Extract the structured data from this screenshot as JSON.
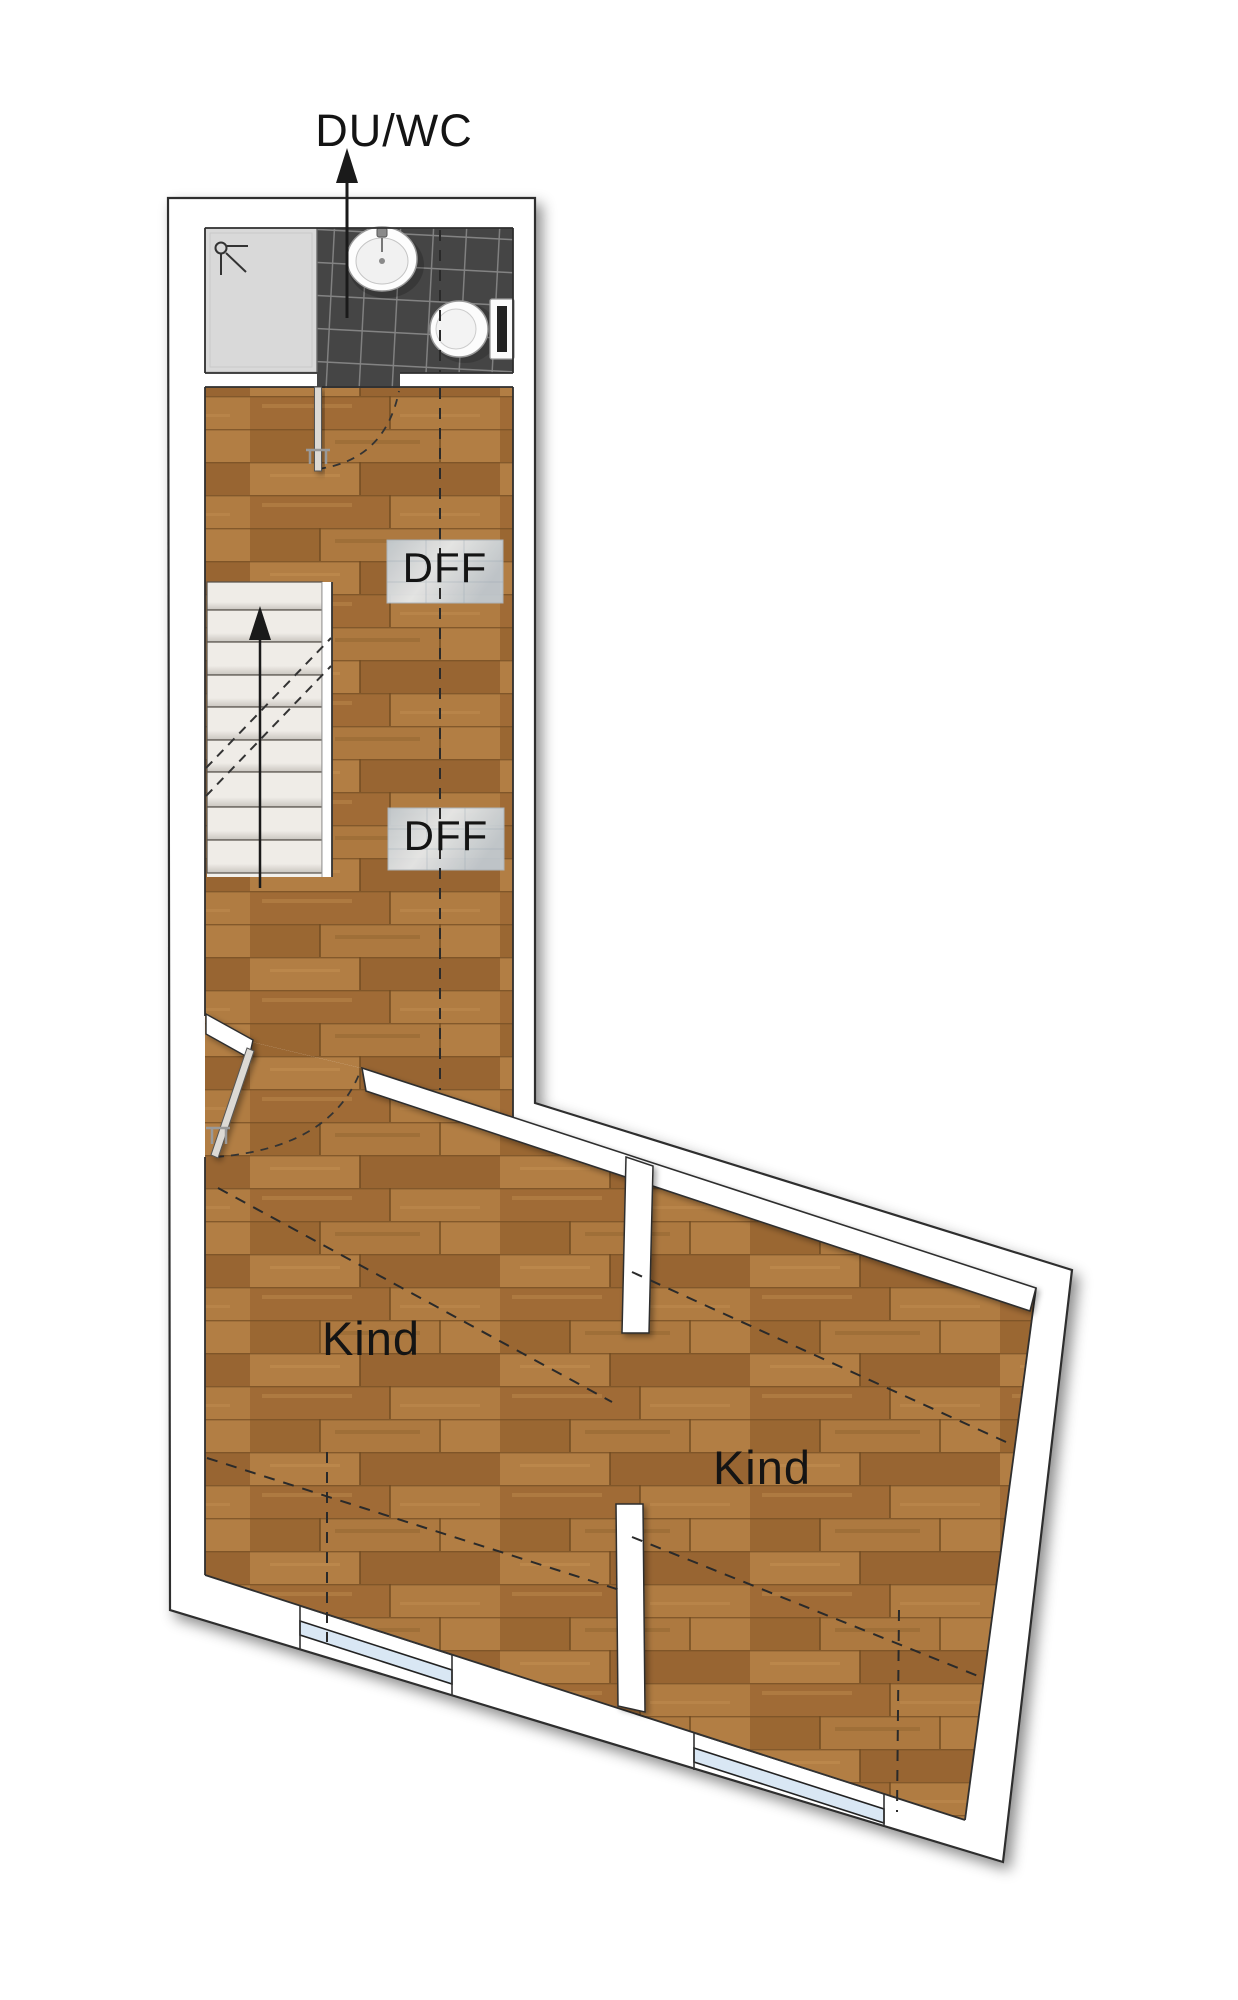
{
  "plan": {
    "bathroom_label": "DU/WC",
    "skylights": [
      {
        "label": "DFF"
      },
      {
        "label": "DFF"
      }
    ],
    "rooms": [
      {
        "label": "Kind"
      },
      {
        "label": "Kind"
      }
    ]
  },
  "icons": {
    "shower": "shower-icon",
    "sink": "sink-icon",
    "toilet": "toilet-icon",
    "stairs_direction": "arrow-up-icon",
    "bath_pointer": "arrow-up-icon",
    "door_swing": "door-swing-arc-icon",
    "skylight": "skylight-icon",
    "window": "window-icon"
  },
  "colors": {
    "wood": "#a8733b",
    "wood-a": "#a06b36",
    "wood-b": "#b07c42",
    "wood-c": "#9a6732",
    "wood-d": "#ad7940",
    "wood-e": "#b27e44",
    "wood-f": "#986532",
    "wood-line": "#6f4a20",
    "wood-row-line": "#7a5226",
    "tile": "#454545",
    "tile-line": "#8a8a8a",
    "shower-tray": "#d9d9d9",
    "stair-light": "#efece7",
    "stair-dark": "#c9c5bf",
    "wall": "#ffffff",
    "outline": "#2f2f2f",
    "glass": "#d9e7f4",
    "skylight-a": "#c2ccd4",
    "skylight-b": "#e9edf0",
    "label": "#141414"
  }
}
